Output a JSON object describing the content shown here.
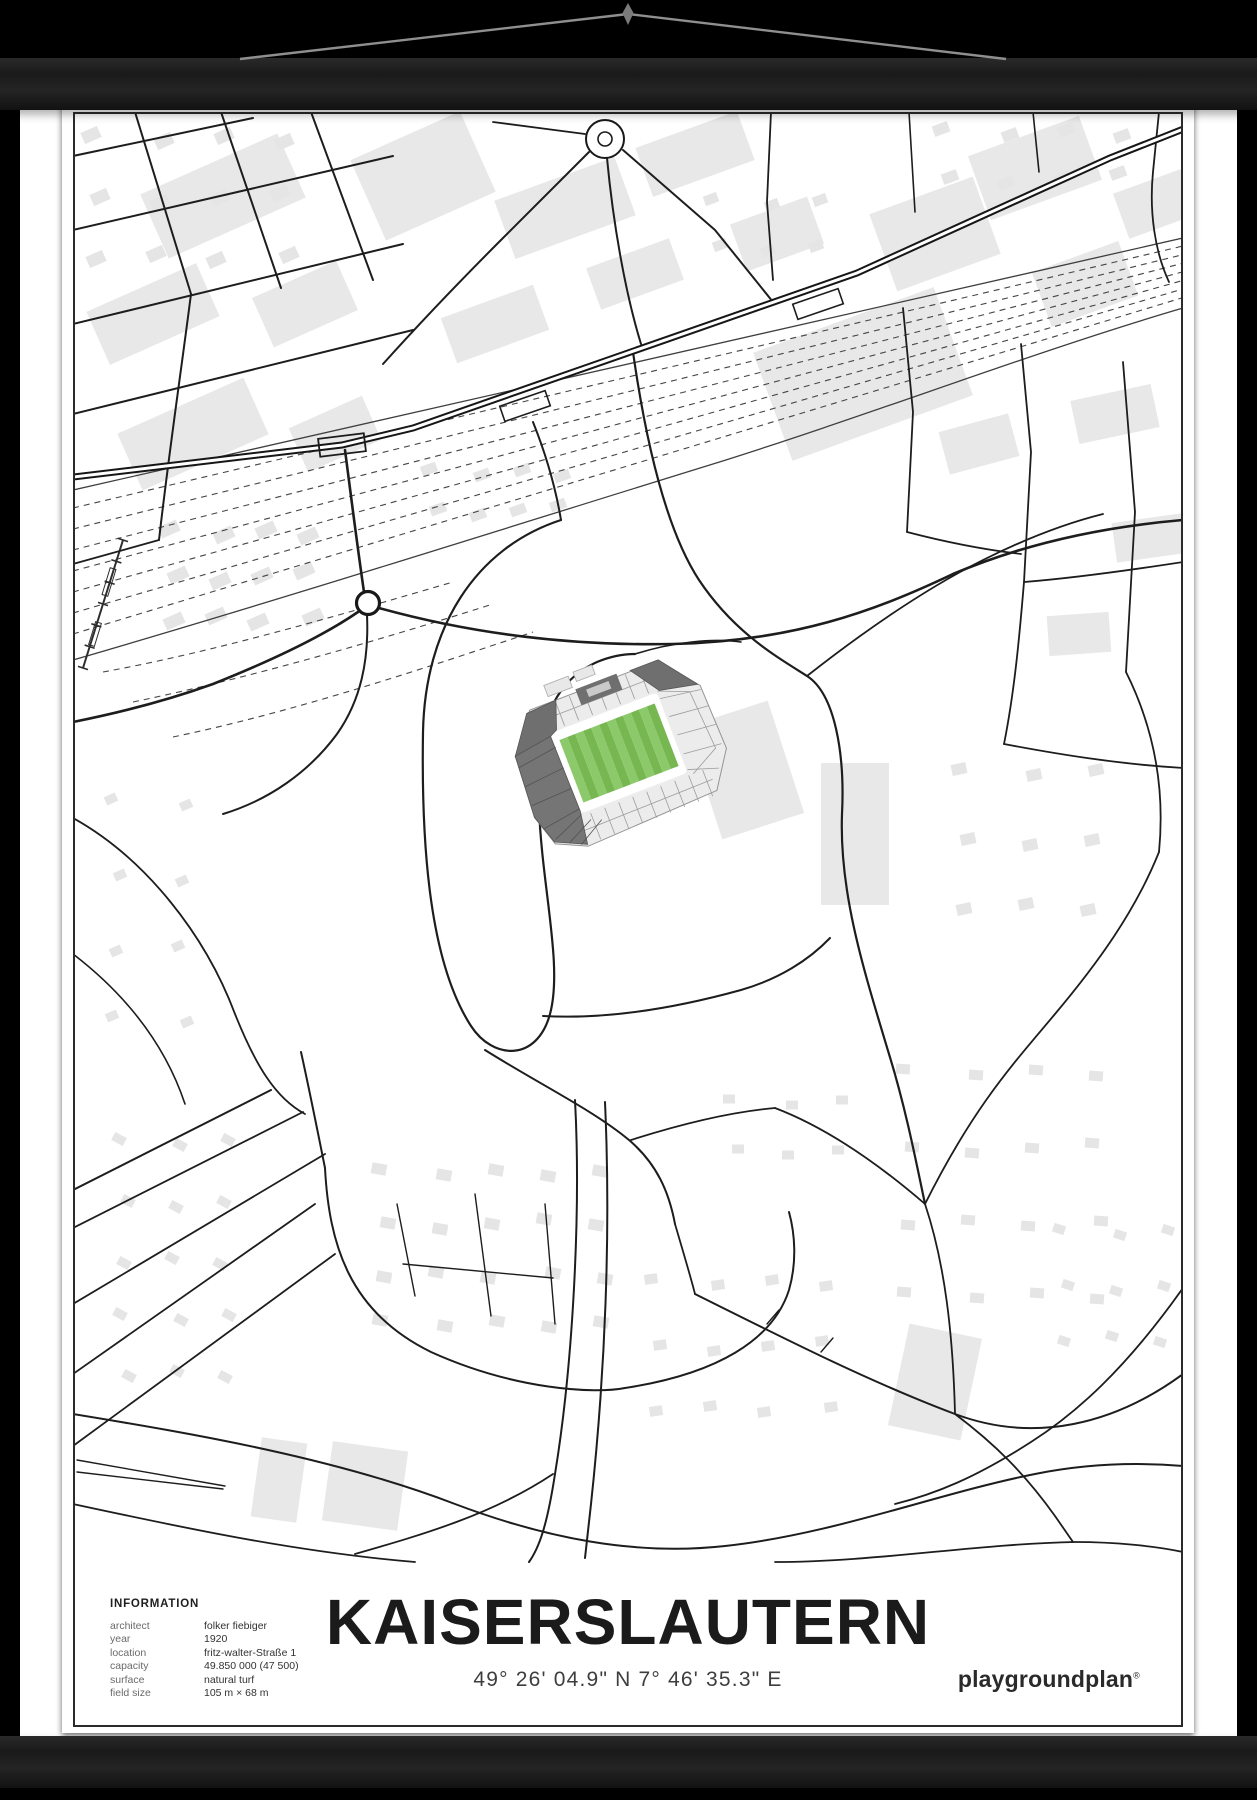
{
  "poster": {
    "title": "KAISERSLAUTERN",
    "coordinates": "49° 26' 04.9\" N  7° 46' 35.3\" E",
    "brand": "playgroundplan",
    "brand_mark": "®",
    "info_heading": "INFORMATION",
    "info_rows": [
      {
        "label": "architect",
        "value": "folker fiebiger"
      },
      {
        "label": "year",
        "value": "1920"
      },
      {
        "label": "location",
        "value": "fritz-walter-Straße 1"
      },
      {
        "label": "capacity",
        "value": "49.850 000 (47 500)"
      },
      {
        "label": "surface",
        "value": "natural turf"
      },
      {
        "label": "field size",
        "value": "105 m × 68 m"
      }
    ]
  },
  "map": {
    "subject": "Fritz-Walter-Stadion football stadium street map",
    "colors": {
      "pitch_green": "#8CC96B",
      "pitch_stripe": "#77B751",
      "stand_dark": "#6F6F6F",
      "stand_light": "#ECECEC",
      "building_gray": "#E8E8E8",
      "road_black": "#1D1D1D",
      "paper_white": "#FFFFFF",
      "rail_wood": "#1E1E1E"
    }
  }
}
